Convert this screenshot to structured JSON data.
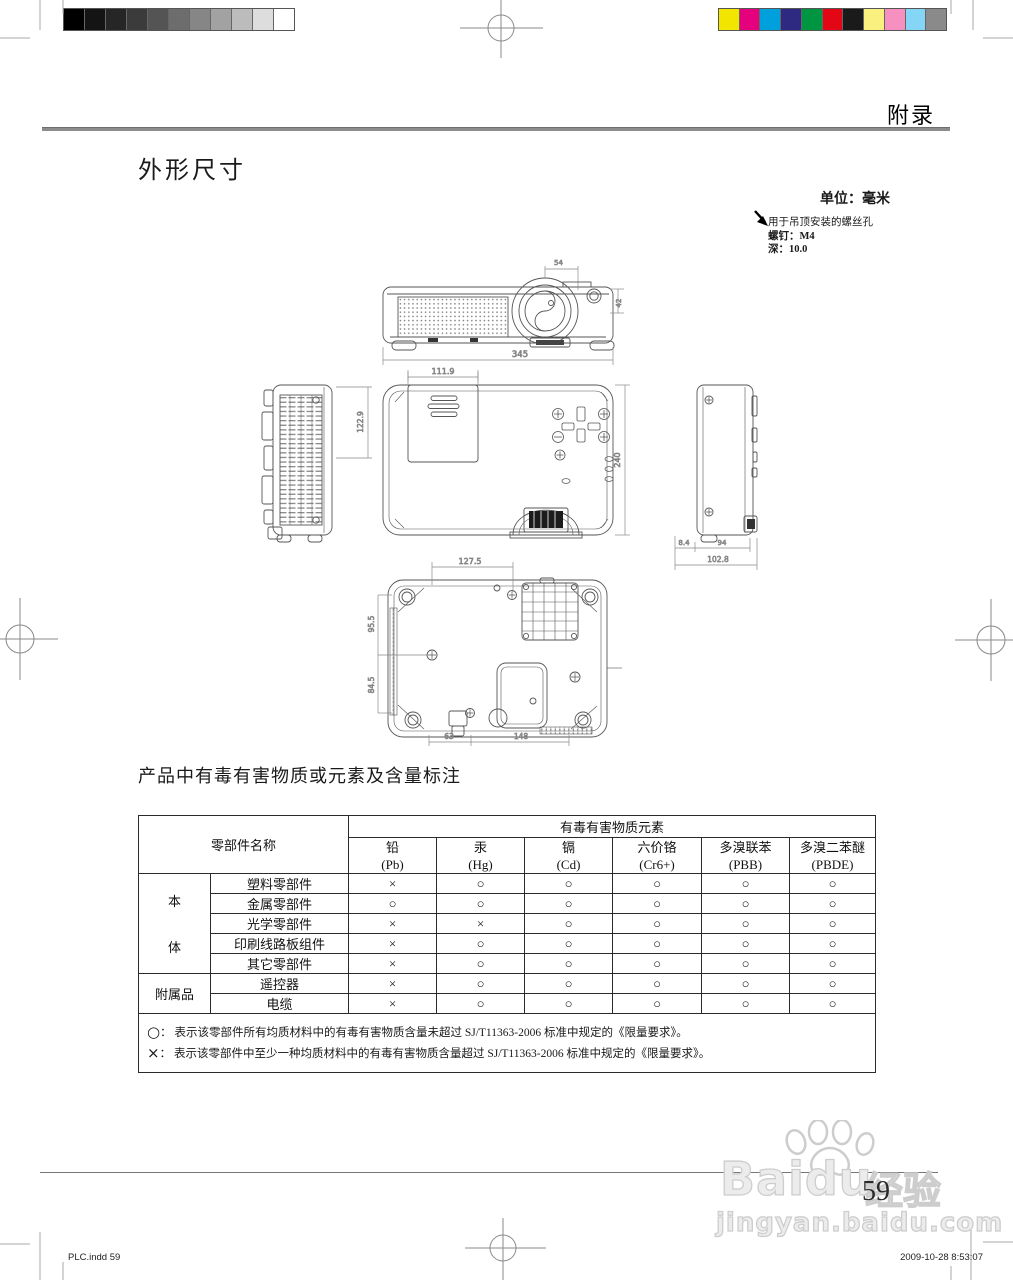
{
  "header": {
    "appendix": "附录"
  },
  "sections": {
    "dimensions_title": "外形尺寸",
    "hazard_title": "产品中有毒有害物质或元素及含量标注"
  },
  "notes": {
    "unit": "单位：毫米",
    "mount_line1": "用于吊顶安装的螺丝孔",
    "mount_line2": "螺钉：M4",
    "mount_line3": "深：10.0"
  },
  "drawing": {
    "dims": {
      "front_top": "54",
      "front_right": "42",
      "front_width": "345",
      "lamp_width": "111.9",
      "lamp_height": "122.9",
      "top_depth": "240",
      "side_foot": "8.4",
      "side_body": "94",
      "side_total": "102.8",
      "bottom_screw_span": "127.5",
      "bottom_left_upper": "95.5",
      "bottom_left_lower": "84.5",
      "bottom_lower_left": "63",
      "bottom_lower_right": "148"
    }
  },
  "table": {
    "name_header": "零部件名称",
    "elements_header": "有毒有害物质元素",
    "columns": [
      {
        "name": "铅",
        "symbol": "(Pb)"
      },
      {
        "name": "汞",
        "symbol": "(Hg)"
      },
      {
        "name": "镉",
        "symbol": "(Cd)"
      },
      {
        "name": "六价铬",
        "symbol": "(Cr6+)"
      },
      {
        "name": "多溴联苯",
        "symbol": "(PBB)"
      },
      {
        "name": "多溴二苯醚",
        "symbol": "(PBDE)"
      }
    ],
    "groups": [
      {
        "label": "本体",
        "vertical": true,
        "rows": [
          {
            "name": "塑料零部件",
            "values": [
              "×",
              "○",
              "○",
              "○",
              "○",
              "○"
            ]
          },
          {
            "name": "金属零部件",
            "values": [
              "○",
              "○",
              "○",
              "○",
              "○",
              "○"
            ]
          },
          {
            "name": "光学零部件",
            "values": [
              "×",
              "×",
              "○",
              "○",
              "○",
              "○"
            ]
          },
          {
            "name": "印刷线路板组件",
            "values": [
              "×",
              "○",
              "○",
              "○",
              "○",
              "○"
            ]
          },
          {
            "name": "其它零部件",
            "values": [
              "×",
              "○",
              "○",
              "○",
              "○",
              "○"
            ]
          }
        ]
      },
      {
        "label": "附属品",
        "vertical": false,
        "rows": [
          {
            "name": "遥控器",
            "values": [
              "×",
              "○",
              "○",
              "○",
              "○",
              "○"
            ]
          },
          {
            "name": "电缆",
            "values": [
              "×",
              "○",
              "○",
              "○",
              "○",
              "○"
            ]
          }
        ]
      }
    ],
    "footnotes": [
      {
        "symbol": "○",
        "text": "：  表示该零部件所有均质材料中的有毒有害物质含量未超过 SJ/T11363-2006 标准中规定的《限量要求》。"
      },
      {
        "symbol": "×",
        "text": "：  表示该零部件中至少一种均质材料中的有毒有害物质含量超过 SJ/T11363-2006 标准中规定的《限量要求》。"
      }
    ]
  },
  "footer": {
    "page_number": "59",
    "print_left": "PLC.indd    59",
    "print_right": "2009-10-28    8:53:07"
  },
  "watermark": {
    "brand": "Baidu",
    "brand_cn": "经验",
    "url": "jingyan.baidu.com"
  },
  "print_marks": {
    "grayscale": [
      "#000000",
      "#141414",
      "#262626",
      "#3b3b3b",
      "#545454",
      "#6d6d6d",
      "#868686",
      "#a2a2a2",
      "#bcbcbc",
      "#dddddd",
      "#ffffff"
    ],
    "colors": [
      "#f2e500",
      "#e5007d",
      "#00a0dd",
      "#2e2a82",
      "#009540",
      "#e30615",
      "#1a1a1a",
      "#f9f07f",
      "#f590c0",
      "#85d5f7",
      "#8a8a8a"
    ]
  }
}
